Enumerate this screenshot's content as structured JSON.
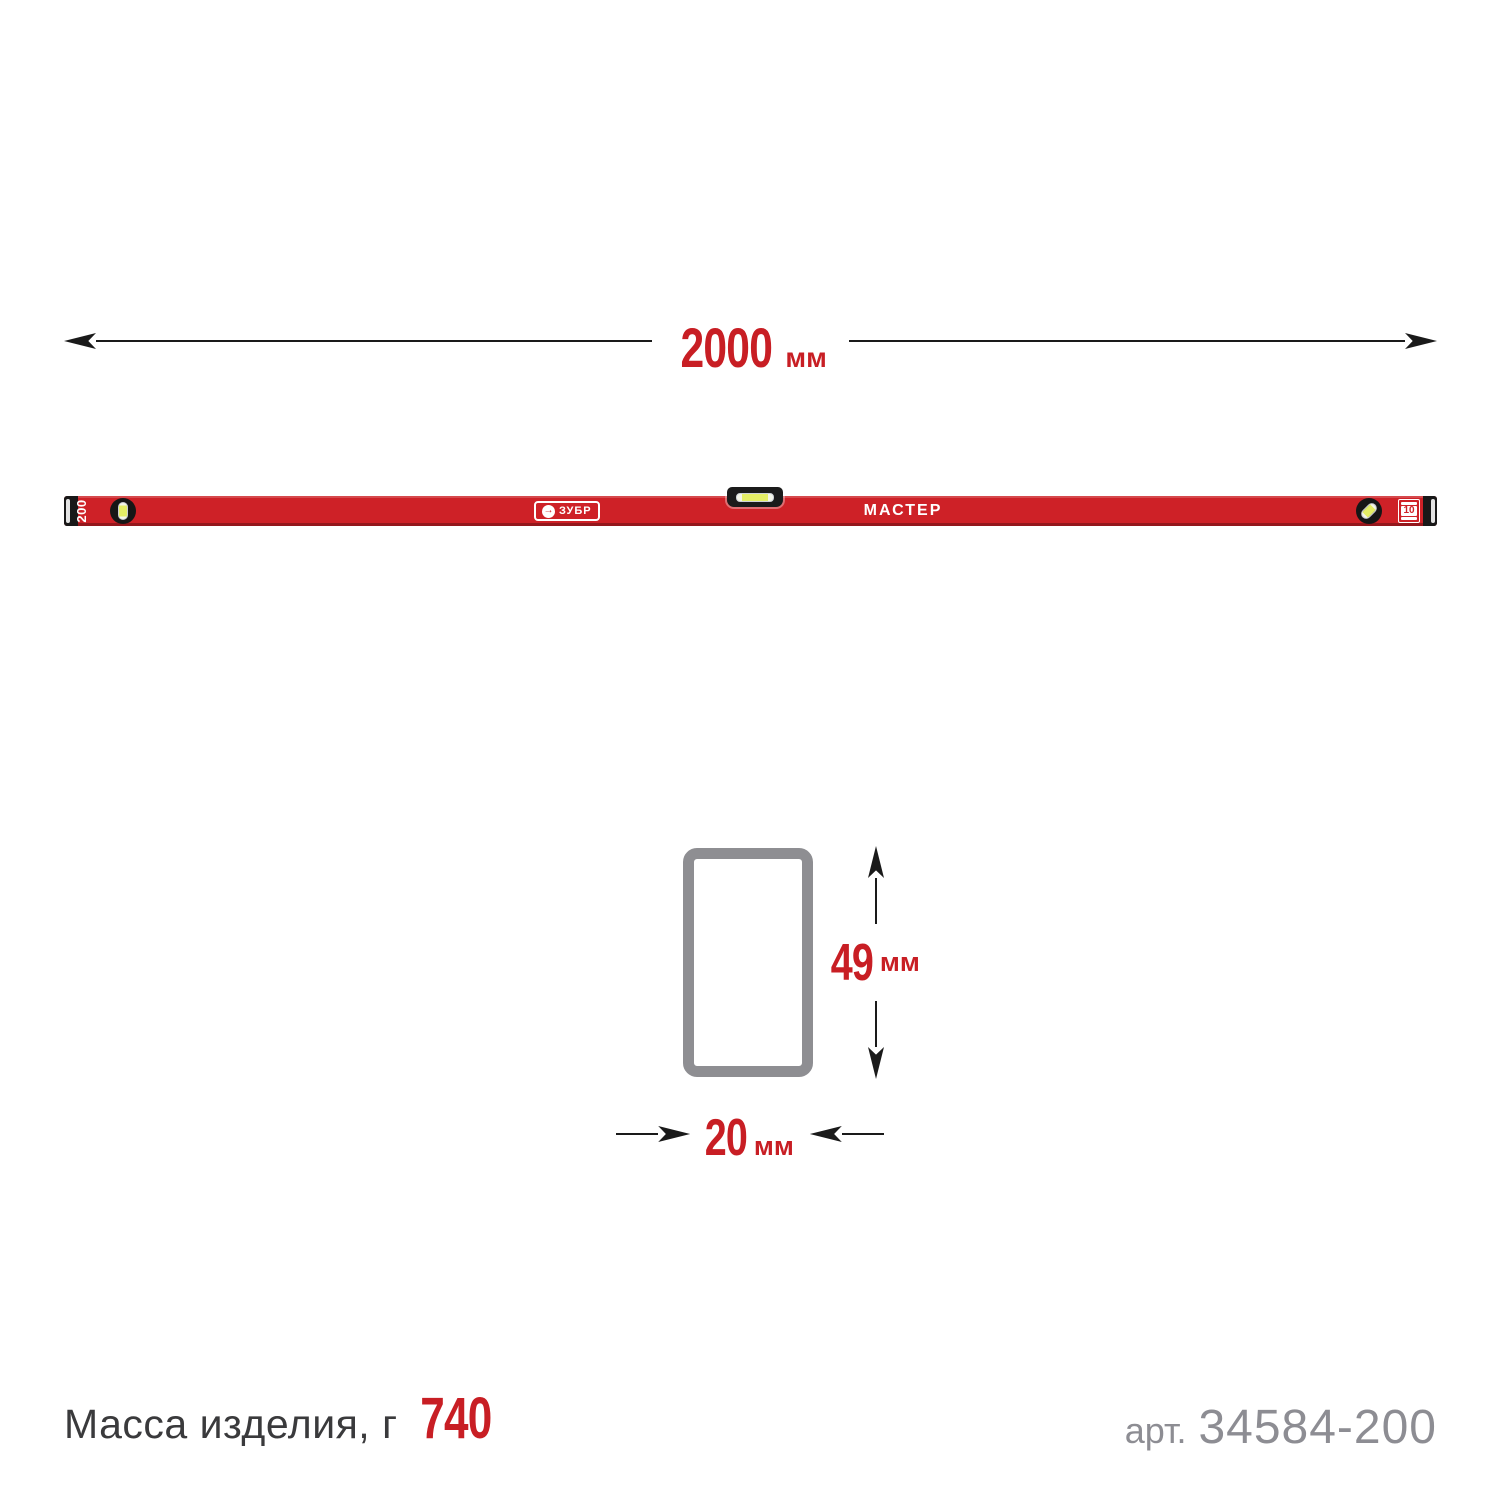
{
  "colors": {
    "level_red": "#ce2127",
    "dim_red": "#c81e24",
    "section_gray": "#8e8e92",
    "muted_gray": "#8d8d93",
    "dark_text": "#3a3a3c",
    "line_black": "#1a1a1a",
    "vial_yellow": "#e4ee66"
  },
  "length_dimension": {
    "value": "2000",
    "unit": "мм"
  },
  "level": {
    "size_label": "200",
    "brand": "ЗУБР",
    "logo_icon": "→",
    "series": "МАСТЕР",
    "badge_value": "10"
  },
  "cross_section": {
    "height_value": "49",
    "height_unit": "мм",
    "width_value": "20",
    "width_unit": "мм"
  },
  "footer": {
    "mass_label": "Масса изделия, г",
    "mass_value": "740",
    "sku_label": "арт.",
    "sku_value": "34584-200"
  }
}
